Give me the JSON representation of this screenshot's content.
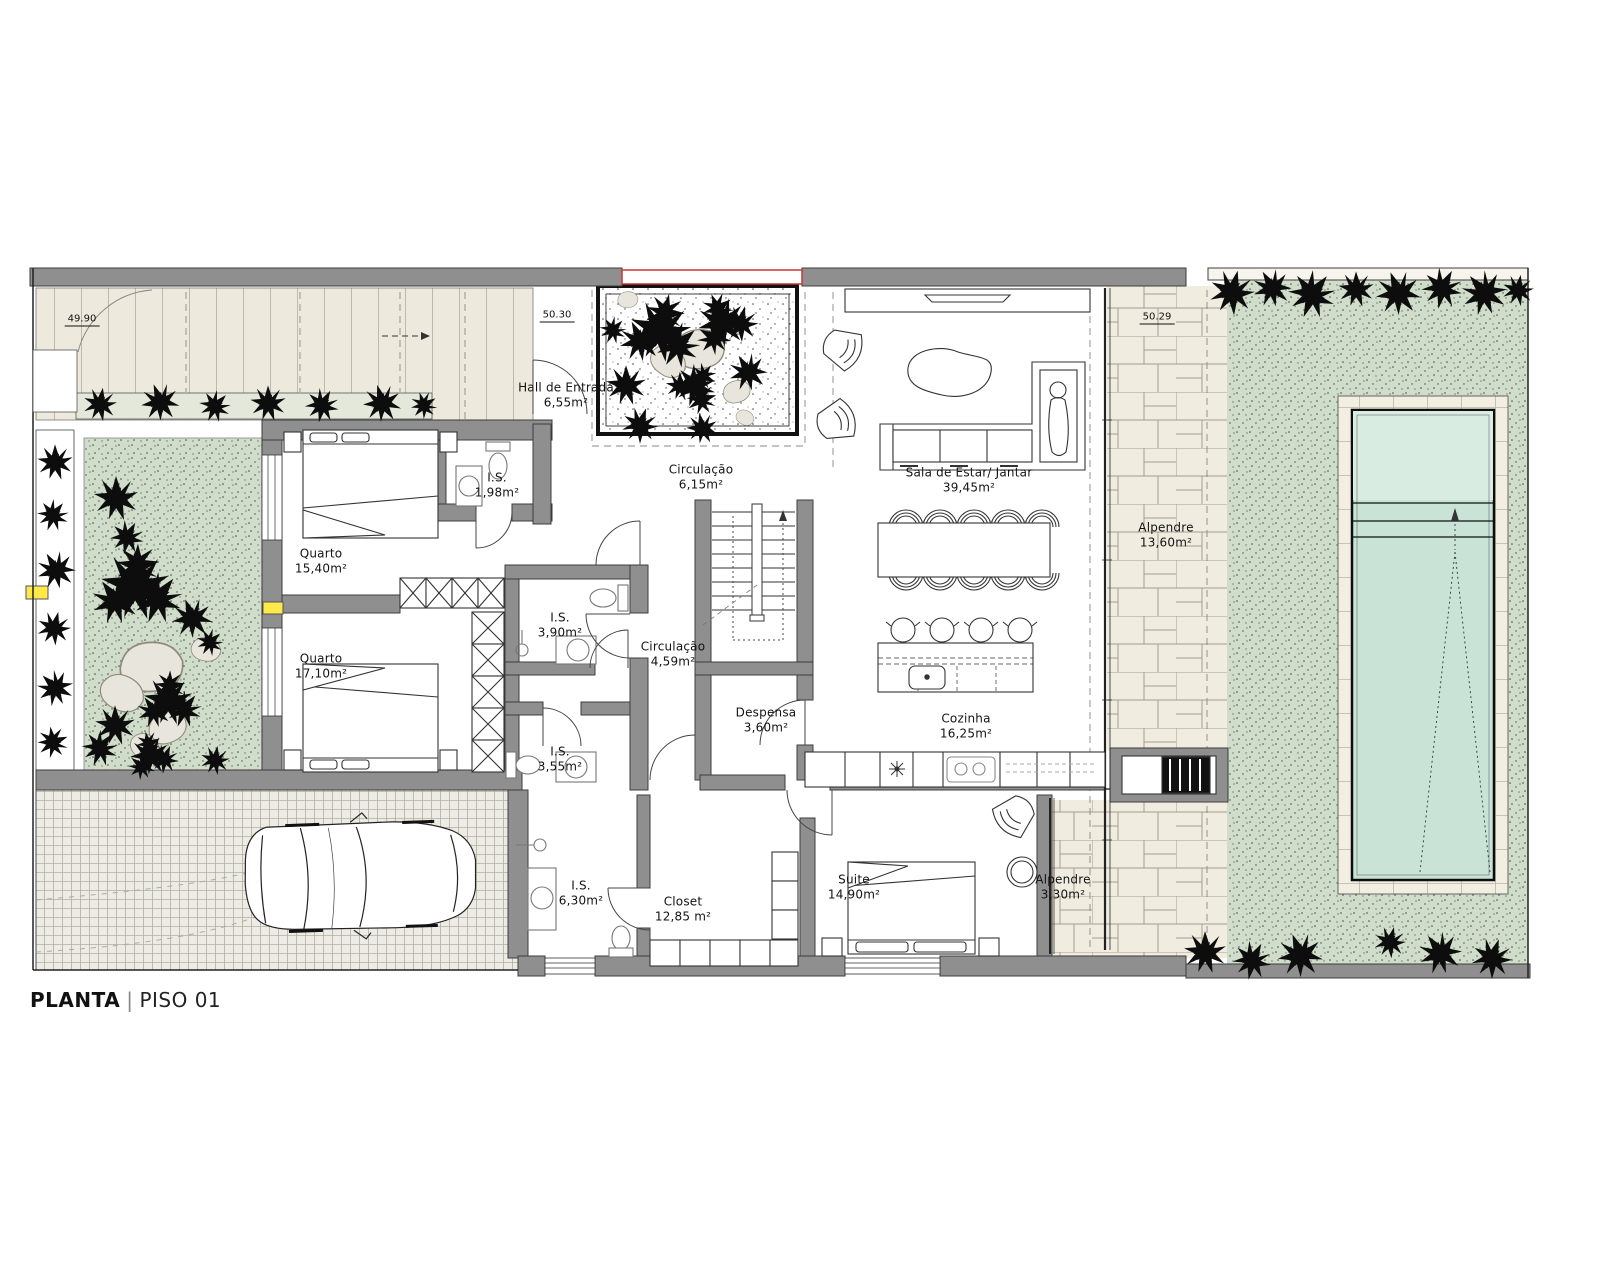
{
  "title": {
    "main": "PLANTA",
    "separator": "|",
    "sub": "PISO 01"
  },
  "levels": [
    {
      "value": "49.90"
    },
    {
      "value": "50.30"
    },
    {
      "value": "50.29"
    }
  ],
  "rooms": [
    {
      "name": "Hall de Entrada",
      "area": "6,55m²"
    },
    {
      "name": "I.S.",
      "area": "1,98m²"
    },
    {
      "name": "Circulação",
      "area": "6,15m²"
    },
    {
      "name": "Sala de Estar/ Jantar",
      "area": "39,45m²"
    },
    {
      "name": "Alpendre",
      "area": "13,60m²"
    },
    {
      "name": "Quarto",
      "area": "15,40m²"
    },
    {
      "name": "Quarto",
      "area": "17,10m²"
    },
    {
      "name": "I.S.",
      "area": "3,90m²"
    },
    {
      "name": "Circulação",
      "area": "4,59m²"
    },
    {
      "name": "Despensa",
      "area": "3,60m²"
    },
    {
      "name": "I.S.",
      "area": "3,55m²"
    },
    {
      "name": "Cozinha",
      "area": "16,25m²"
    },
    {
      "name": "I.S.",
      "area": "6,30m²"
    },
    {
      "name": "Closet",
      "area": "12,85 m²"
    },
    {
      "name": "Suite",
      "area": "14,90m²"
    },
    {
      "name": "Alpendre",
      "area": "3,30m²"
    }
  ],
  "colors": {
    "wall_gray": "#8f8f8f",
    "pool_water": "#c9e4d7",
    "lawn_green": "#cfddca",
    "stone_beige": "#f0ecdf",
    "deck_beige": "#edeadd",
    "opening_red": "#cc3333",
    "marker_yellow": "#ffe84a"
  }
}
